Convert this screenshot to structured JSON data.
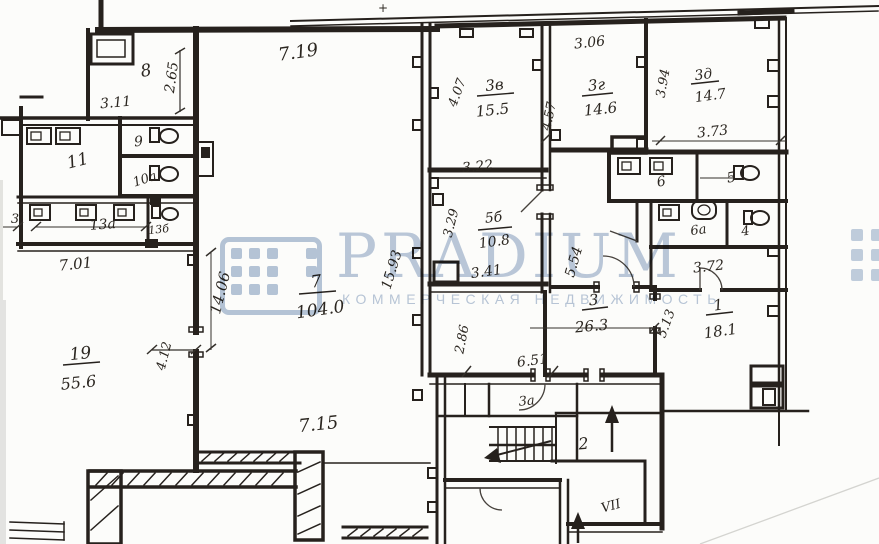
{
  "watermark": {
    "brand": "PRADIUM",
    "subtitle": "КОММЕРЧЕСКАЯ НЕДВИЖИМОСТЬ",
    "color": "#aec0d6"
  },
  "palette": {
    "ink": "#26211d",
    "paper": "#fcfcfa"
  },
  "rooms": {
    "r1": "1",
    "r2": "2",
    "r3": "3",
    "r3a": "3а",
    "r3v": "3в",
    "r3g": "3г",
    "r3d": "3д",
    "r4": "4",
    "r5": "5",
    "r5b": "5б",
    "r6": "6",
    "r6a": "6а",
    "r7": "7",
    "r8": "8",
    "r9": "9",
    "r10a": "10а",
    "r11": "11",
    "r13a": "13а",
    "r13b": "13б",
    "r19": "19",
    "edge3": "3"
  },
  "areas": {
    "a1": "18.1",
    "a3": "26.3",
    "a3v": "15.5",
    "a3g": "14.6",
    "a3d": "14.7",
    "a5b": "10.8",
    "a7": "104.0",
    "a19": "55.6"
  },
  "dims": {
    "d719": "7.19",
    "d306": "3.06",
    "d265": "2.65",
    "d311": "3.11",
    "d407": "4.07",
    "d457": "4.57",
    "d394": "3.94",
    "d373": "3.73",
    "d322": "3.22",
    "d329": "3.29",
    "d341": "3.41",
    "d701": "7.01",
    "d1406": "14.06",
    "d1593": "15.93",
    "d554": "5.54",
    "d372": "3.72",
    "d513": "5.13",
    "d412": "4.12",
    "d286": "2.86",
    "d651": "6.51",
    "d715": "7.15"
  },
  "marks": {
    "plus": "+",
    "section": "VII"
  }
}
